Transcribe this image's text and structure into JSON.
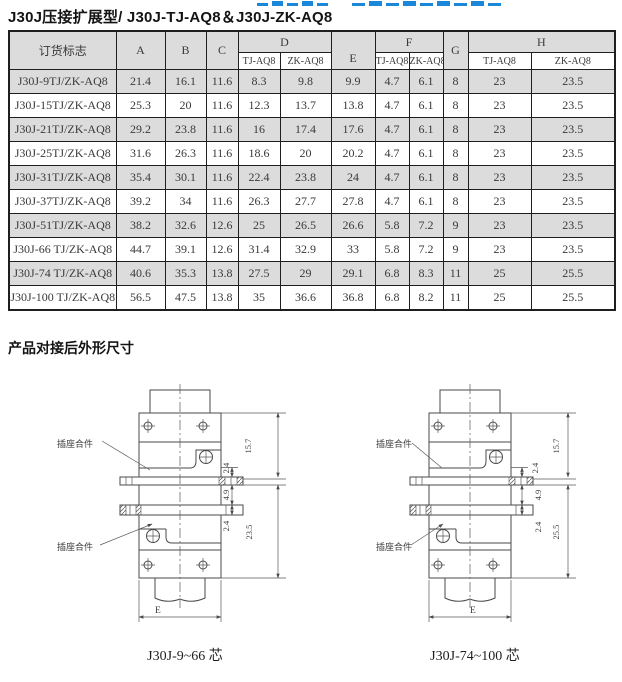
{
  "colors": {
    "banner_blue": "#1b87d8",
    "row_stripe": "#dcdcdc",
    "table_border": "#1f1f1f"
  },
  "header": {
    "title": "J30J压接扩展型/ J30J-TJ-AQ8＆J30J-ZK-AQ8"
  },
  "table": {
    "columns": {
      "order": "订货标志",
      "a": "A",
      "b": "B",
      "c": "C",
      "d": "D",
      "e": "E",
      "f": "F",
      "g": "G",
      "h": "H",
      "sub_tj": "TJ-AQ8",
      "sub_zk": "ZK-AQ8"
    },
    "rows": [
      {
        "model": "J30J-9TJ/ZK-AQ8",
        "values": [
          "21.4",
          "16.1",
          "11.6",
          "8.3",
          "9.8",
          "9.9",
          "4.7",
          "6.1",
          "8",
          "23",
          "23.5"
        ]
      },
      {
        "model": "J30J-15TJ/ZK-AQ8",
        "values": [
          "25.3",
          "20",
          "11.6",
          "12.3",
          "13.7",
          "13.8",
          "4.7",
          "6.1",
          "8",
          "23",
          "23.5"
        ]
      },
      {
        "model": "J30J-21TJ/ZK-AQ8",
        "values": [
          "29.2",
          "23.8",
          "11.6",
          "16",
          "17.4",
          "17.6",
          "4.7",
          "6.1",
          "8",
          "23",
          "23.5"
        ]
      },
      {
        "model": "J30J-25TJ/ZK-AQ8",
        "values": [
          "31.6",
          "26.3",
          "11.6",
          "18.6",
          "20",
          "20.2",
          "4.7",
          "6.1",
          "8",
          "23",
          "23.5"
        ]
      },
      {
        "model": "J30J-31TJ/ZK-AQ8",
        "values": [
          "35.4",
          "30.1",
          "11.6",
          "22.4",
          "23.8",
          "24",
          "4.7",
          "6.1",
          "8",
          "23",
          "23.5"
        ]
      },
      {
        "model": "J30J-37TJ/ZK-AQ8",
        "values": [
          "39.2",
          "34",
          "11.6",
          "26.3",
          "27.7",
          "27.8",
          "4.7",
          "6.1",
          "8",
          "23",
          "23.5"
        ]
      },
      {
        "model": "J30J-51TJ/ZK-AQ8",
        "values": [
          "38.2",
          "32.6",
          "12.6",
          "25",
          "26.5",
          "26.6",
          "5.8",
          "7.2",
          "9",
          "23",
          "23.5"
        ]
      },
      {
        "model": "J30J-66 TJ/ZK-AQ8",
        "values": [
          "44.7",
          "39.1",
          "12.6",
          "31.4",
          "32.9",
          "33",
          "5.8",
          "7.2",
          "9",
          "23",
          "23.5"
        ]
      },
      {
        "model": "J30J-74 TJ/ZK-AQ8",
        "values": [
          "40.6",
          "35.3",
          "13.8",
          "27.5",
          "29",
          "29.1",
          "6.8",
          "8.3",
          "11",
          "25",
          "25.5"
        ]
      },
      {
        "model": "J30J-100 TJ/ZK-AQ8",
        "values": [
          "56.5",
          "47.5",
          "13.8",
          "35",
          "36.6",
          "36.8",
          "6.8",
          "8.2",
          "11",
          "25",
          "25.5"
        ]
      }
    ]
  },
  "section": {
    "title": "产品对接后外形尺寸"
  },
  "diagrams": {
    "left": {
      "part_label_top": "插座合件",
      "part_label_bottom": "插座合件",
      "dim_top": "15.7",
      "dim_s1": "2.4",
      "dim_s2": "4.9",
      "dim_s3": "2.4",
      "dim_bottom": "23.5",
      "dim_width": "E",
      "caption": "J30J-9~66 芯"
    },
    "right": {
      "part_label_top": "插座合件",
      "part_label_bottom": "插座合件",
      "dim_top": "15.7",
      "dim_s1": "2.4",
      "dim_s2": "4.9",
      "dim_s3": "2.4",
      "dim_bottom": "25.5",
      "dim_width": "E",
      "caption": "J30J-74~100 芯"
    }
  }
}
